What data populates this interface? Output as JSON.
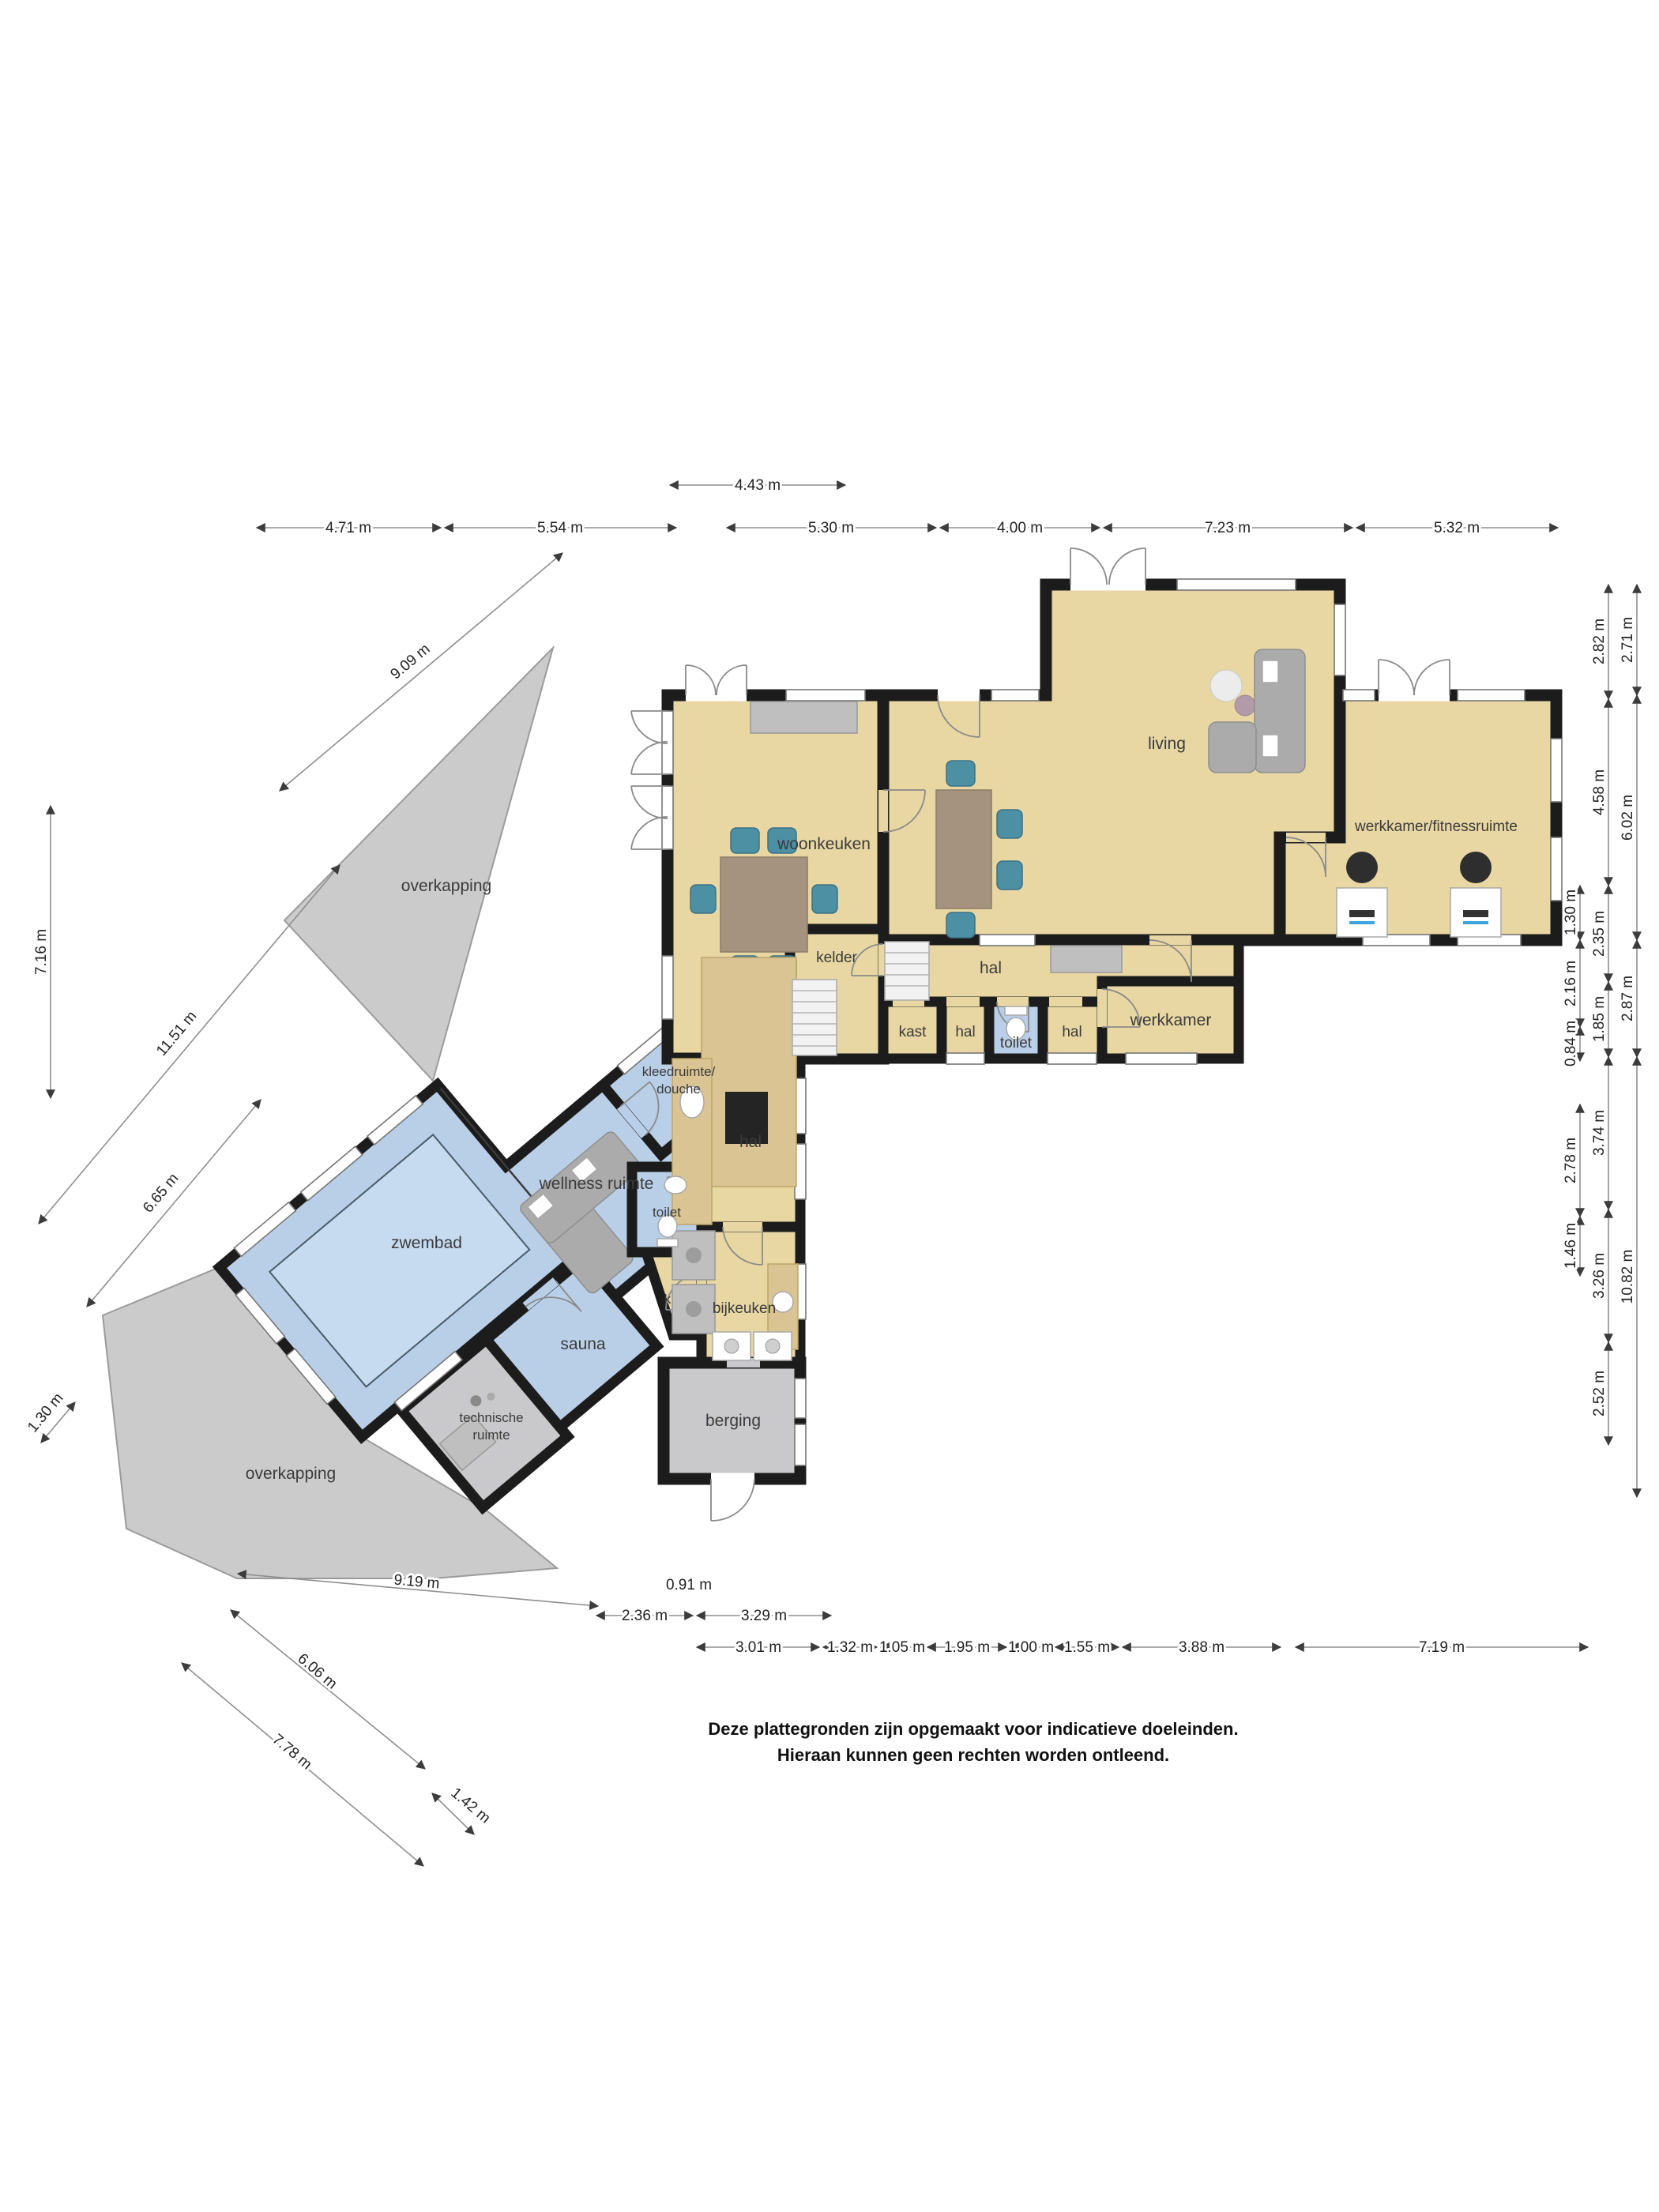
{
  "plan": {
    "rooms": {
      "living": "living",
      "woonkeuken": "woonkeuken",
      "fitness": "werkkamer/fitnessruimte",
      "hal_main": "hal",
      "kelder": "kelder",
      "kast": "kast",
      "hal_small1": "hal",
      "toilet_main": "toilet",
      "hal_small2": "hal",
      "werkkamer": "werkkamer",
      "kleedruimte_line1": "kleedruimte/",
      "kleedruimte_line2": "douche",
      "wellness": "wellness ruimte",
      "hal_wellness": "hal",
      "toilet_wellness": "toilet",
      "zwembad": "zwembad",
      "bijkeuken": "bijkeuken",
      "k": "k",
      "sauna": "sauna",
      "technische_line1": "technische",
      "technische_line2": "ruimte",
      "berging": "berging",
      "overkapping_top": "overkapping",
      "overkapping_bottom": "overkapping"
    },
    "dims": {
      "top_single": "4.43 m",
      "top_row": [
        "4.71 m",
        "5.54 m",
        "5.30 m",
        "4.00 m",
        "7.23 m",
        "5.32 m"
      ],
      "right_inner": [
        "1.30 m",
        "2.16 m",
        "0.84 m",
        "2.78 m",
        "1.46 m"
      ],
      "right_mid": [
        "2.82 m",
        "4.58 m",
        "2.35 m",
        "1.85 m",
        "3.74 m",
        "3.26 m",
        "2.52 m"
      ],
      "right_outer": [
        "2.71 m",
        "6.02 m",
        "2.87 m",
        "10.82 m"
      ],
      "left": [
        "7.16 m",
        "9.09 m",
        "11.51 m",
        "6.65 m",
        "1.30 m"
      ],
      "bottom_left": [
        "9.19 m",
        "6.06 m",
        "7.78 m",
        "1.42 m"
      ],
      "bottom_row1": [
        "0.91 m",
        "2.36 m",
        "3.29 m"
      ],
      "bottom_row2": [
        "3.01 m",
        "1.32 m",
        "1.05 m",
        "1.95 m",
        "1.00 m",
        "1.55 m",
        "3.88 m",
        "7.19 m"
      ]
    },
    "disclaimer": {
      "line1": "Deze plattegronden zijn opgemaakt voor indicatieve doeleinden.",
      "line2": "Hieraan kunnen geen rechten worden ontleend."
    },
    "colors": {
      "floor_tan": "#E8D7A3",
      "floor_blue": "#B9CFE8",
      "pool_water": "#C6DAF0",
      "floor_gray": "#C9C9CB",
      "overkapping": "#CBCBCB",
      "wall": "#1C1C1C",
      "chair_teal": "#4D8FA3"
    }
  }
}
